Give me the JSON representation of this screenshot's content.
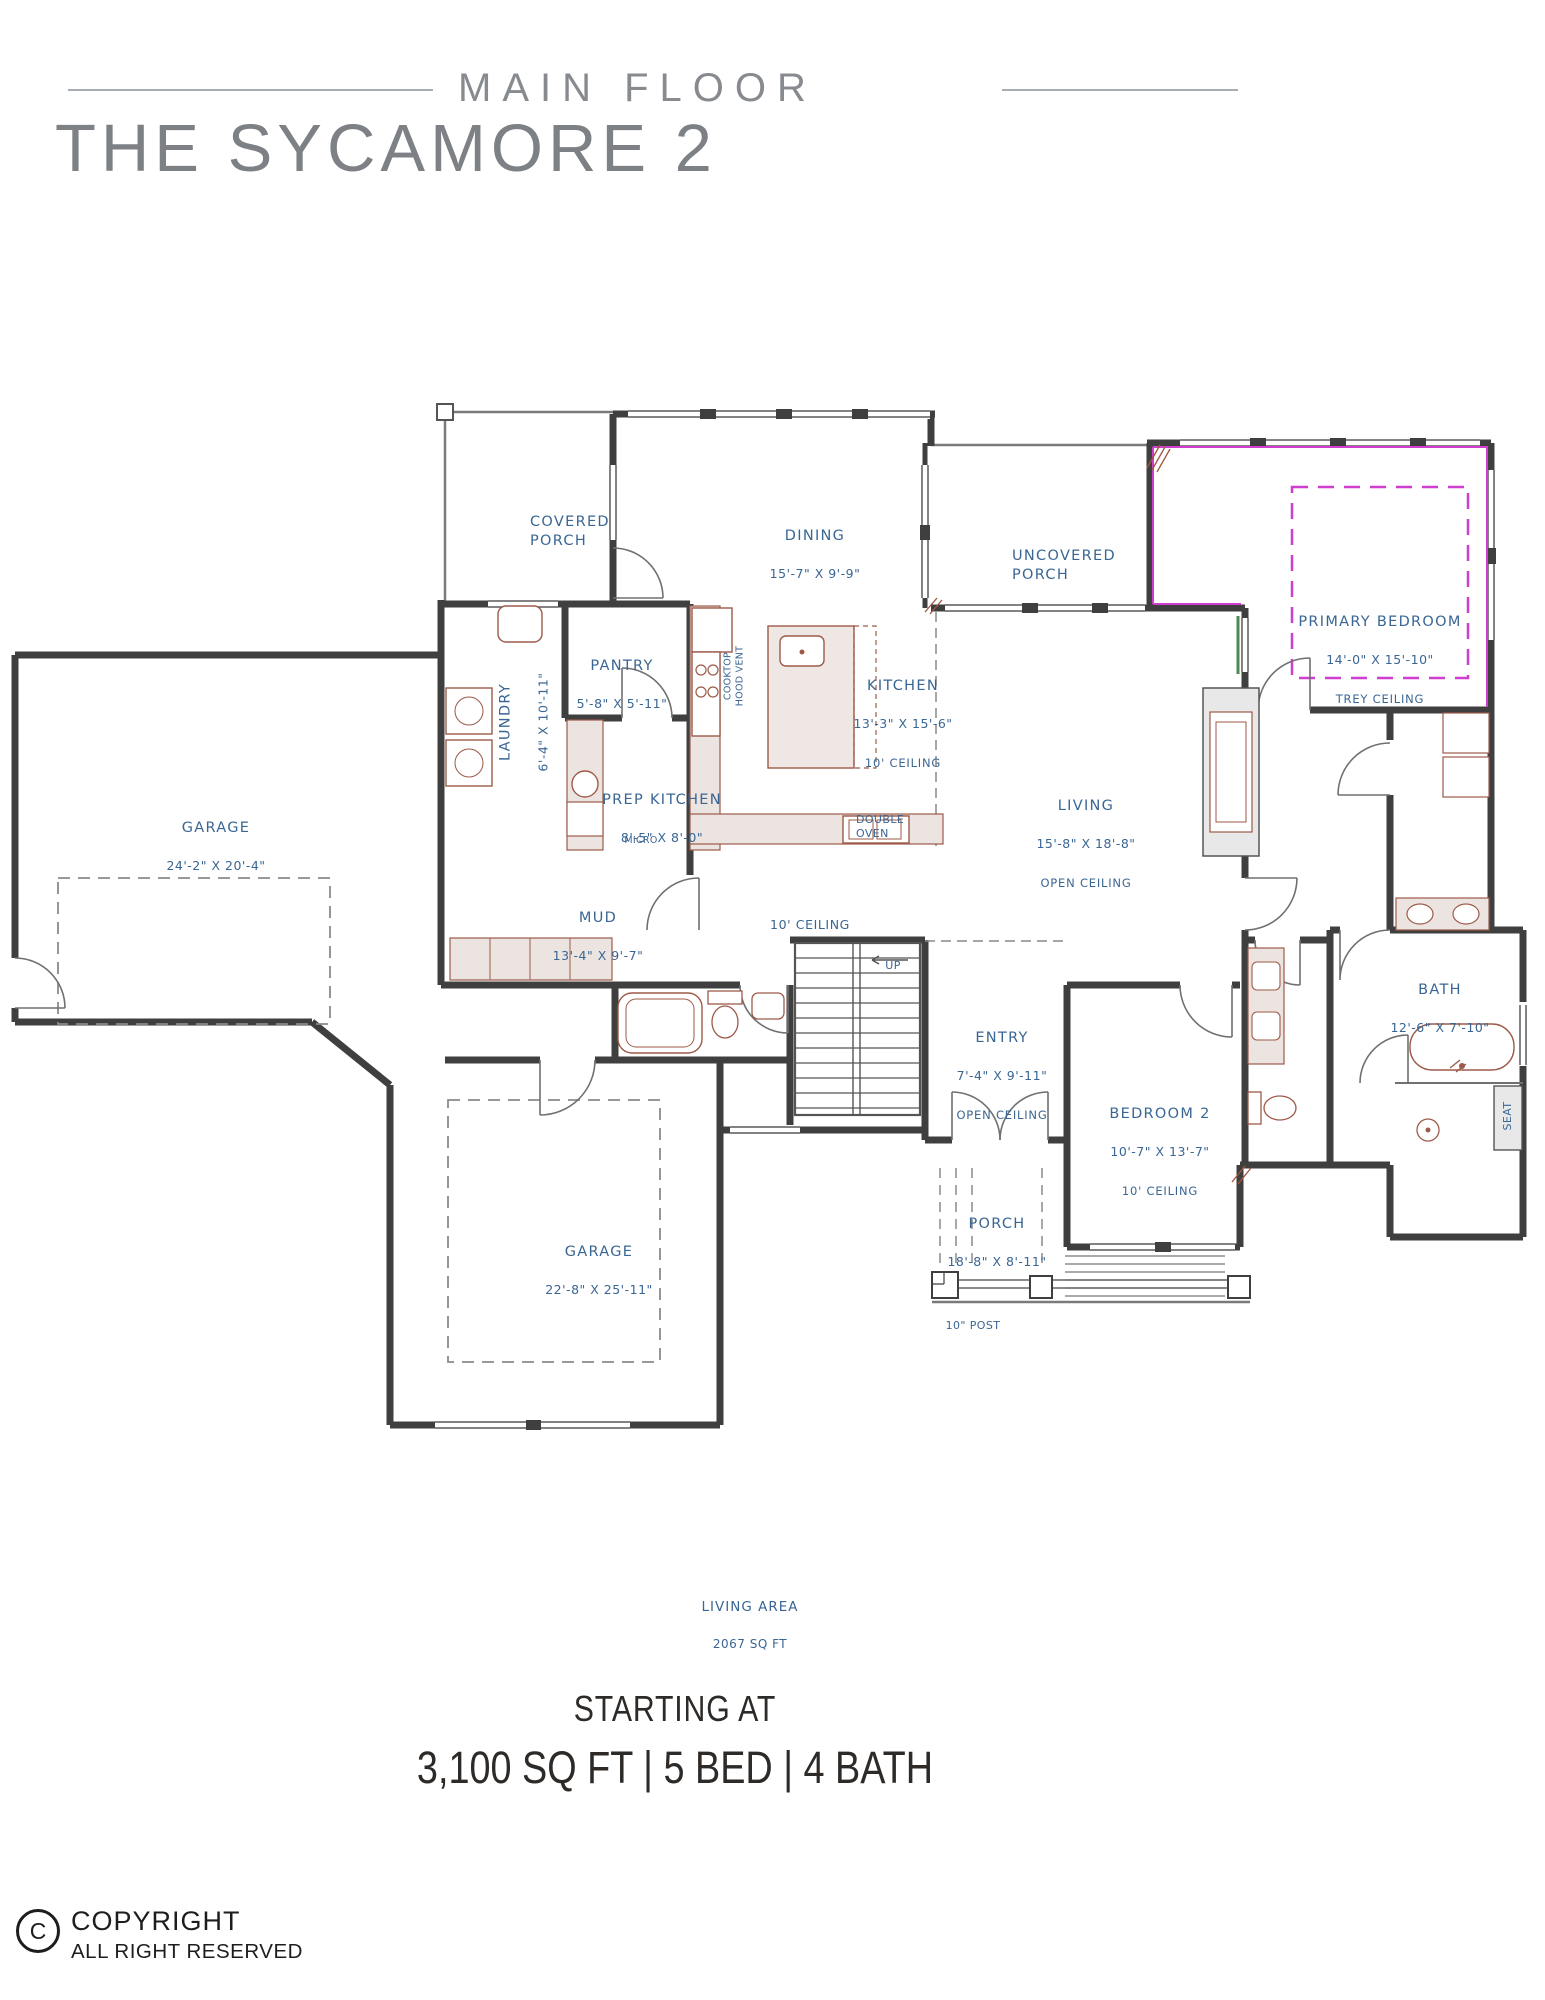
{
  "header": {
    "floor_label": "MAIN FLOOR",
    "title": "THE SYCAMORE 2"
  },
  "rooms": {
    "covered_porch": {
      "name": "COVERED\nPORCH"
    },
    "dining": {
      "name": "DINING",
      "dims": "15'-7\" X 9'-9\""
    },
    "uncovered_porch": {
      "name": "UNCOVERED\nPORCH"
    },
    "primary_bedroom": {
      "name": "PRIMARY BEDROOM",
      "dims": "14'-0\" X 15'-10\"",
      "note": "TREY CEILING"
    },
    "pantry": {
      "name": "PANTRY",
      "dims": "5'-8\" X 5'-11\""
    },
    "laundry": {
      "name": "LAUNDRY",
      "dims": "6'-4\" X 10'-11\""
    },
    "kitchen": {
      "name": "KITCHEN",
      "dims": "13'-3\" X 15'-6\"",
      "note": "10' CEILING"
    },
    "prep_kitchen": {
      "name": "PREP KITCHEN",
      "dims": "8'-5\" X 8'-0\""
    },
    "garage_1": {
      "name": "GARAGE",
      "dims": "24'-2\" X 20'-4\""
    },
    "mud": {
      "name": "MUD",
      "dims": "13'-4\" X 9'-7\""
    },
    "living": {
      "name": "LIVING",
      "dims": "15'-8\" X 18'-8\"",
      "note": "OPEN CEILING"
    },
    "entry": {
      "name": "ENTRY",
      "dims": "7'-4\" X 9'-11\"",
      "note": "OPEN CEILING"
    },
    "bedroom_2": {
      "name": "BEDROOM 2",
      "dims": "10'-7\" X 13'-7\"",
      "note": "10' CEILING"
    },
    "bath": {
      "name": "BATH",
      "dims": "12'-6\" X 7'-10\""
    },
    "porch": {
      "name": "PORCH",
      "dims": "18'-8\" X 8'-11\""
    },
    "garage_2": {
      "name": "GARAGE",
      "dims": "22'-8\" X 25'-11\""
    }
  },
  "annotations": {
    "cooktop_vent": "COOKTOP\nHOOD VENT",
    "micro": "MICRO",
    "double_oven": "DOUBLE\nOVEN",
    "hall_ceiling": "10' CEILING",
    "up": "UP",
    "seat": "SEAT",
    "post": "10\" POST",
    "living_area_title": "LIVING AREA",
    "living_area_value": "2067 SQ FT"
  },
  "footer": {
    "starting_at": "STARTING AT",
    "specs": "3,100 SQ FT | 5 BED | 4 BATH"
  },
  "copyright": {
    "symbol": "C",
    "line1": "COPYRIGHT",
    "line2": "ALL RIGHT RESERVED"
  },
  "colors": {
    "label_blue": "#3a6694",
    "wall": "#3f3f3f",
    "magenta": "#cf3ecf",
    "fixture_red": "#9d5a49",
    "header_gray": "#85898d",
    "text_dark": "#2d2a27",
    "accent_green": "#4c8a52"
  }
}
